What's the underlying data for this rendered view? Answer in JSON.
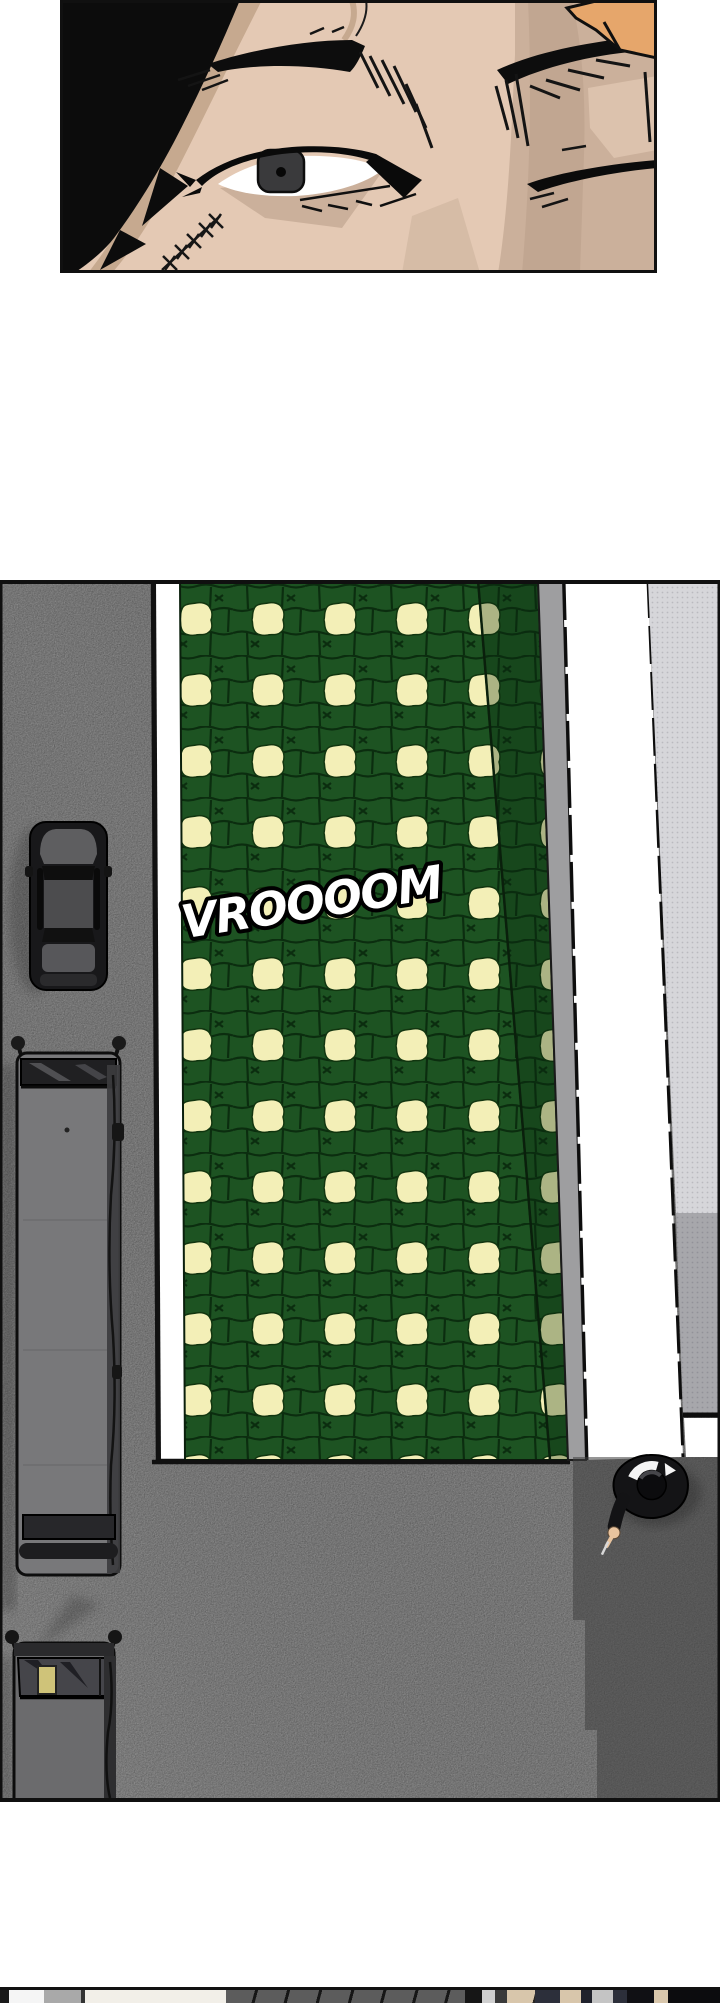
{
  "page": {
    "width": 720,
    "height": 2000,
    "background": "#ffffff"
  },
  "panels": {
    "face": {
      "name": "face-closeup",
      "description": "close-up of scarred man's eyes"
    },
    "street": {
      "name": "street-overhead",
      "description": "top-down street with green paved crosswalk, vehicles and pedestrian"
    },
    "next": {
      "name": "next-panel-sliver"
    }
  },
  "sfx": {
    "text": "VROOOOM"
  },
  "palette": {
    "page_bg": "#ffffff",
    "skin": "#e4c9b4",
    "skin_shadow": "#cbb09b",
    "skin_deep": "#bfa48f",
    "skin_patch": "#dcc2ad",
    "hair": "#0c0c0c",
    "hair_shadow": "#c6a98f",
    "highlight_patch": "#e6a66b",
    "road": "#7c7c7c",
    "road_dark": "#6e6e6e",
    "shadow": "#3f3f3f",
    "crosswalk_green": "#1d5322",
    "crosswalk_mortar": "#0b2d0f",
    "paver_cream": "#f3efb7",
    "strip_gray": "#9e9ea0",
    "white": "#ffffff",
    "sidewalk_light": "#d6d6da",
    "sidewalk_mid": "#a7a7ab",
    "vehicle_gray": "#78787a",
    "vehicle_dark": "#18181a",
    "glass_dark": "#202022",
    "cargo_yellow": "#cfc379",
    "person_black": "#141416",
    "person_skin": "#e9c49e",
    "sfx_fill": "#ffffff",
    "sfx_outline": "#000000"
  },
  "next_panel": {
    "segments": [
      {
        "w": 9,
        "c": "#1a1a1a",
        "striped": false
      },
      {
        "w": 35,
        "c": "#f5f5f5",
        "striped": false
      },
      {
        "w": 37,
        "c": "#a9a9a9",
        "striped": false
      },
      {
        "w": 4,
        "c": "#333333",
        "striped": false
      },
      {
        "w": 141,
        "c": "#f2efe8",
        "striped": false
      },
      {
        "w": 239,
        "c": "#5c5c5c",
        "striped": true
      },
      {
        "w": 17,
        "c": "#161616",
        "striped": false
      },
      {
        "w": 13,
        "c": "#cfcfcf",
        "striped": false
      },
      {
        "w": 12,
        "c": "#3a3a3a",
        "striped": false
      },
      {
        "w": 28,
        "c": "#d8c6ab",
        "striped": true
      },
      {
        "w": 25,
        "c": "#2c2f3a",
        "striped": false
      },
      {
        "w": 21,
        "c": "#d8c6ab",
        "striped": false
      },
      {
        "w": 11,
        "c": "#20222c",
        "striped": false
      },
      {
        "w": 21,
        "c": "#c4c4c4",
        "striped": false
      },
      {
        "w": 14,
        "c": "#2c2f3a",
        "striped": false
      },
      {
        "w": 27,
        "c": "#101014",
        "striped": false
      },
      {
        "w": 14,
        "c": "#d8c6ab",
        "striped": false
      },
      {
        "w": 52,
        "c": "#0c0c0e",
        "striped": false
      }
    ]
  }
}
